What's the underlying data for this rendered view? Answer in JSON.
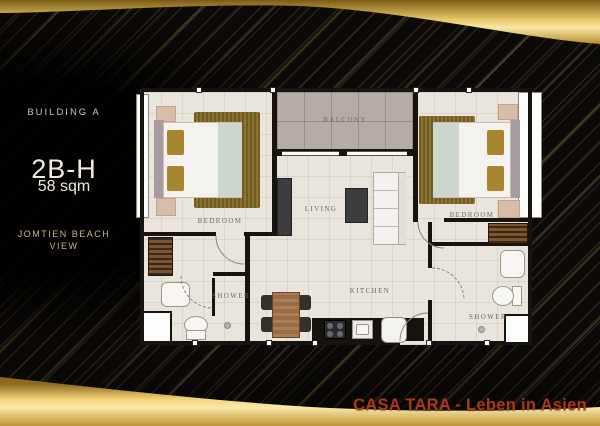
{
  "info_panel": {
    "building_label": "BUILDING A",
    "unit_code": "2B-H",
    "unit_area": "58 sqm",
    "view_line1": "JOMTIEN BEACH",
    "view_line2": "VIEW"
  },
  "floorplan": {
    "labels": {
      "bedroom_left": "BEDROOM",
      "bedroom_right": "BEDROOM",
      "balcony": "BALCONY",
      "living": "LIVING",
      "kitchen": "KITCHEN",
      "shower_left": "SHOWER",
      "shower_right": "SHOWER"
    }
  },
  "footer": {
    "brand_text": "CASA TARA - Leben in Asien"
  },
  "colors": {
    "bg": "#0c0a08",
    "goldDark": "#8a6318",
    "goldLight": "#f3d87d",
    "goldPale": "#f9e8a6",
    "goldDeep": "#c09637",
    "brandRed": "#a93a1b",
    "floorCream": "#eae5dc",
    "balconyGray": "#b3ada6",
    "wallBlack": "#17130f",
    "rugGold": "#8b7330",
    "labelGray": "#6e6962",
    "panelCream": "#f1ebdf",
    "panelTan": "#cdc4b2",
    "viewTan": "#c9b68c"
  }
}
